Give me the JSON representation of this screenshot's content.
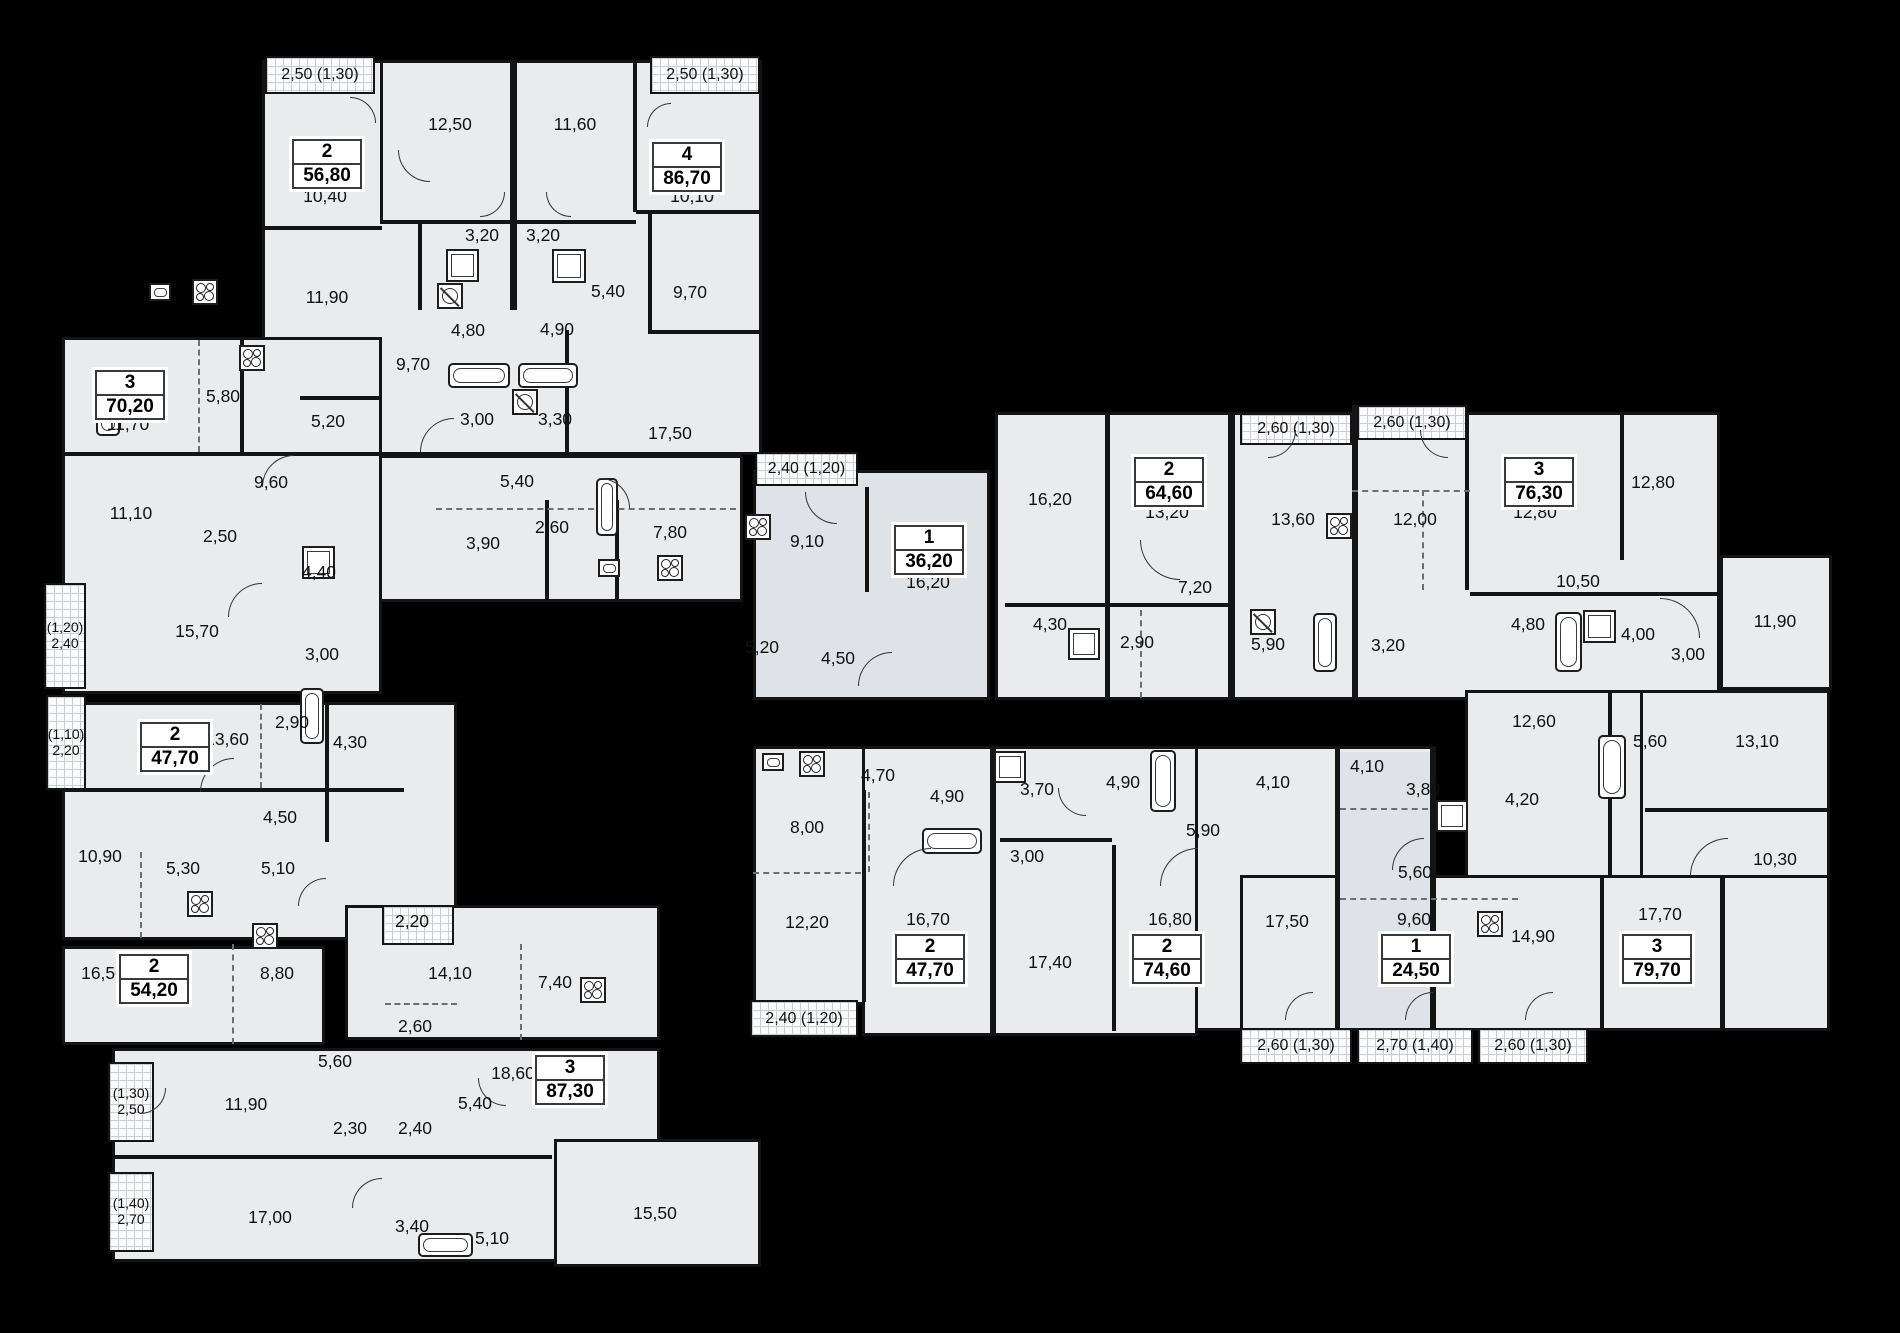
{
  "colors": {
    "background": "#000000",
    "floor": "#e9ebed",
    "floor_dark": "#dfe2e6",
    "wall": "#141414",
    "label": "#111111",
    "balcony_fill": "#fbfbfb",
    "balcony_grid": "#c9ced3"
  },
  "apartments": [
    {
      "type": "2",
      "area": "56,80",
      "x": 325,
      "y": 162
    },
    {
      "type": "4",
      "area": "86,70",
      "x": 685,
      "y": 165
    },
    {
      "type": "3",
      "area": "70,20",
      "x": 128,
      "y": 393
    },
    {
      "type": "1",
      "area": "36,20",
      "x": 927,
      "y": 548
    },
    {
      "type": "2",
      "area": "64,60",
      "x": 1167,
      "y": 480
    },
    {
      "type": "3",
      "area": "76,30",
      "x": 1537,
      "y": 480
    },
    {
      "type": "2",
      "area": "47,70",
      "x": 173,
      "y": 745
    },
    {
      "type": "2",
      "area": "54,20",
      "x": 152,
      "y": 977
    },
    {
      "type": "3",
      "area": "87,30",
      "x": 568,
      "y": 1078
    },
    {
      "type": "2",
      "area": "47,70",
      "x": 928,
      "y": 957
    },
    {
      "type": "2",
      "area": "74,60",
      "x": 1165,
      "y": 957
    },
    {
      "type": "1",
      "area": "24,50",
      "x": 1414,
      "y": 957
    },
    {
      "type": "3",
      "area": "79,70",
      "x": 1655,
      "y": 957
    }
  ],
  "rooms": [
    [
      "12,50",
      450,
      125
    ],
    [
      "11,60",
      575,
      125
    ],
    [
      "10,40",
      325,
      197
    ],
    [
      "10,10",
      692,
      197
    ],
    [
      "11,90",
      327,
      298
    ],
    [
      "3,20",
      482,
      236
    ],
    [
      "3,20",
      543,
      236
    ],
    [
      "5,40",
      608,
      292
    ],
    [
      "9,70",
      690,
      293
    ],
    [
      "4,80",
      468,
      331
    ],
    [
      "4,90",
      557,
      330
    ],
    [
      "9,70",
      413,
      365
    ],
    [
      "5,20",
      328,
      422
    ],
    [
      "3,00",
      477,
      420
    ],
    [
      "3,30",
      555,
      420
    ],
    [
      "17,50",
      670,
      434
    ],
    [
      "5,40",
      517,
      482
    ],
    [
      "3,90",
      483,
      544
    ],
    [
      "2,60",
      552,
      528
    ],
    [
      "7,80",
      670,
      533
    ],
    [
      "5,80",
      223,
      397
    ],
    [
      "11,70",
      128,
      425
    ],
    [
      "9,60",
      271,
      483
    ],
    [
      "11,10",
      131,
      514
    ],
    [
      "2,50",
      220,
      537
    ],
    [
      "4,40",
      319,
      573
    ],
    [
      "15,70",
      197,
      632
    ],
    [
      "3,00",
      322,
      655
    ],
    [
      "9,10",
      807,
      542
    ],
    [
      "16,20",
      928,
      583
    ],
    [
      "5,20",
      762,
      648
    ],
    [
      "4,50",
      838,
      659
    ],
    [
      "16,20",
      1050,
      500
    ],
    [
      "13,20",
      1167,
      513
    ],
    [
      "13,60",
      1293,
      520
    ],
    [
      "7,20",
      1195,
      588
    ],
    [
      "4,30",
      1050,
      625
    ],
    [
      "2,90",
      1137,
      643
    ],
    [
      "5,90",
      1268,
      645
    ],
    [
      "3,20",
      1388,
      646
    ],
    [
      "12,00",
      1415,
      520
    ],
    [
      "12,80",
      1535,
      513
    ],
    [
      "12,80",
      1653,
      483
    ],
    [
      "10,50",
      1578,
      582
    ],
    [
      "4,80",
      1528,
      625
    ],
    [
      "4,00",
      1638,
      635
    ],
    [
      "3,00",
      1688,
      655
    ],
    [
      "11,90",
      1775,
      622
    ],
    [
      "12,60",
      1534,
      722
    ],
    [
      "5,60",
      1650,
      742
    ],
    [
      "13,10",
      1757,
      742
    ],
    [
      "4,20",
      1522,
      800
    ],
    [
      "10,30",
      1775,
      860
    ],
    [
      "4,10",
      1367,
      767
    ],
    [
      "3,80",
      1423,
      790
    ],
    [
      "5,60",
      1415,
      873
    ],
    [
      "9,60",
      1414,
      920
    ],
    [
      "17,50",
      1287,
      922
    ],
    [
      "14,90",
      1533,
      937
    ],
    [
      "17,70",
      1660,
      915
    ],
    [
      "4,70",
      878,
      776
    ],
    [
      "4,90",
      947,
      797
    ],
    [
      "8,00",
      807,
      828
    ],
    [
      "12,20",
      807,
      923
    ],
    [
      "16,70",
      928,
      920
    ],
    [
      "3,70",
      1037,
      790
    ],
    [
      "4,90",
      1123,
      783
    ],
    [
      "3,00",
      1027,
      857
    ],
    [
      "5,90",
      1203,
      831
    ],
    [
      "4,10",
      1273,
      783
    ],
    [
      "17,40",
      1050,
      963
    ],
    [
      "16,80",
      1170,
      920
    ],
    [
      "13,60",
      227,
      740
    ],
    [
      "2,90",
      292,
      723
    ],
    [
      "4,30",
      350,
      743
    ],
    [
      "4,50",
      280,
      818
    ],
    [
      "10,90",
      100,
      857
    ],
    [
      "5,30",
      183,
      869
    ],
    [
      "5,10",
      278,
      869
    ],
    [
      "16,50",
      103,
      974
    ],
    [
      "8,80",
      277,
      974
    ],
    [
      "2,20",
      412,
      922
    ],
    [
      "14,10",
      450,
      974
    ],
    [
      "7,40",
      555,
      983
    ],
    [
      "2,60",
      415,
      1027
    ],
    [
      "5,60",
      335,
      1062
    ],
    [
      "18,60",
      513,
      1074
    ],
    [
      "11,90",
      246,
      1105
    ],
    [
      "5,40",
      475,
      1104
    ],
    [
      "2,30",
      350,
      1129
    ],
    [
      "2,40",
      415,
      1129
    ],
    [
      "17,00",
      270,
      1218
    ],
    [
      "3,40",
      412,
      1227
    ],
    [
      "5,10",
      492,
      1239
    ],
    [
      "15,50",
      655,
      1214
    ]
  ],
  "balconies": [
    {
      "label": "2,50 (1,30)",
      "r": [
        265,
        56,
        110,
        38
      ]
    },
    {
      "label": "2,50 (1,30)",
      "r": [
        650,
        56,
        110,
        38
      ]
    },
    {
      "label": "(1,20)\n2,40",
      "r": [
        44,
        583,
        42,
        106
      ]
    },
    {
      "label": "(1,10)\n2,20",
      "r": [
        46,
        695,
        40,
        95
      ]
    },
    {
      "label": "2,40 (1,20)",
      "r": [
        755,
        452,
        103,
        34
      ]
    },
    {
      "label": "2,60 (1,30)",
      "r": [
        1240,
        413,
        112,
        32
      ]
    },
    {
      "label": "2,60 (1,30)",
      "r": [
        1357,
        405,
        110,
        35
      ]
    },
    {
      "label": "2,40 (1,20)",
      "r": [
        750,
        1000,
        108,
        37
      ]
    },
    {
      "label": "2,60 (1,30)",
      "r": [
        1240,
        1028,
        112,
        36
      ]
    },
    {
      "label": "2,70 (1,40)",
      "r": [
        1357,
        1028,
        116,
        36
      ]
    },
    {
      "label": "2,60 (1,30)",
      "r": [
        1478,
        1028,
        110,
        36
      ]
    },
    {
      "label": "(1,30)\n2,50",
      "r": [
        108,
        1062,
        46,
        80
      ]
    },
    {
      "label": "(1,40)\n2,70",
      "r": [
        108,
        1172,
        46,
        80
      ]
    },
    {
      "label": "",
      "r": [
        382,
        905,
        72,
        40
      ]
    }
  ],
  "blocks": [
    [
      262,
      60,
      500,
      395
    ],
    [
      375,
      455,
      368,
      147
    ],
    [
      62,
      337,
      320,
      357
    ],
    [
      753,
      470,
      237,
      230,
      "b"
    ],
    [
      995,
      412,
      725,
      288
    ],
    [
      1720,
      555,
      112,
      135
    ],
    [
      1465,
      690,
      365,
      190
    ],
    [
      1640,
      690,
      190,
      341
    ],
    [
      995,
      746,
      440,
      285
    ],
    [
      1240,
      875,
      590,
      156
    ],
    [
      753,
      746,
      445,
      259
    ],
    [
      862,
      746,
      336,
      290
    ],
    [
      62,
      702,
      395,
      238
    ],
    [
      62,
      946,
      263,
      99
    ],
    [
      345,
      905,
      315,
      135
    ],
    [
      112,
      1048,
      548,
      214
    ],
    [
      554,
      1139,
      207,
      128
    ]
  ],
  "shades": [
    [
      1338,
      752,
      94,
      276
    ]
  ],
  "walls": [
    [
      510,
      62,
      7,
      248
    ],
    [
      633,
      62,
      4,
      150
    ],
    [
      380,
      62,
      3,
      160
    ],
    [
      262,
      226,
      120,
      4
    ],
    [
      380,
      220,
      256,
      4
    ],
    [
      418,
      224,
      4,
      86
    ],
    [
      636,
      210,
      126,
      4
    ],
    [
      648,
      214,
      4,
      118
    ],
    [
      62,
      452,
      318,
      4
    ],
    [
      240,
      337,
      4,
      115
    ],
    [
      300,
      396,
      80,
      4
    ],
    [
      380,
      452,
      140,
      4
    ],
    [
      565,
      330,
      4,
      126
    ],
    [
      648,
      330,
      114,
      4
    ],
    [
      545,
      500,
      4,
      100
    ],
    [
      615,
      500,
      4,
      100
    ],
    [
      865,
      487,
      4,
      105
    ],
    [
      1105,
      412,
      5,
      285
    ],
    [
      1228,
      412,
      7,
      288
    ],
    [
      1352,
      405,
      6,
      295
    ],
    [
      1465,
      412,
      4,
      178
    ],
    [
      1620,
      412,
      4,
      148
    ],
    [
      1470,
      592,
      252,
      4
    ],
    [
      1005,
      603,
      225,
      4
    ],
    [
      1608,
      690,
      4,
      186
    ],
    [
      1645,
      808,
      185,
      4
    ],
    [
      1430,
      746,
      6,
      284
    ],
    [
      1335,
      746,
      5,
      284
    ],
    [
      1600,
      875,
      4,
      156
    ],
    [
      1720,
      875,
      5,
      156
    ],
    [
      862,
      790,
      4,
      212
    ],
    [
      990,
      746,
      6,
      290
    ],
    [
      1112,
      845,
      4,
      186
    ],
    [
      1000,
      838,
      112,
      4
    ],
    [
      62,
      788,
      342,
      4
    ],
    [
      325,
      702,
      4,
      140
    ],
    [
      112,
      1155,
      440,
      4
    ]
  ],
  "dashed": [
    [
      198,
      340,
      2,
      112,
      "v"
    ],
    [
      436,
      508,
      300,
      2,
      "h"
    ],
    [
      1140,
      610,
      2,
      88,
      "v"
    ],
    [
      1352,
      490,
      118,
      2,
      "h"
    ],
    [
      1422,
      490,
      2,
      100,
      "v"
    ],
    [
      1340,
      808,
      88,
      2,
      "h"
    ],
    [
      1340,
      898,
      178,
      2,
      "h"
    ],
    [
      753,
      872,
      108,
      2,
      "h"
    ],
    [
      868,
      792,
      2,
      80,
      "v"
    ],
    [
      232,
      944,
      2,
      100,
      "v"
    ],
    [
      260,
      704,
      2,
      84,
      "v"
    ],
    [
      385,
      1003,
      72,
      2,
      "h"
    ],
    [
      140,
      852,
      2,
      86,
      "v"
    ],
    [
      520,
      944,
      2,
      96,
      "v"
    ]
  ],
  "fixtures": {
    "stoves": [
      [
        239,
        345
      ],
      [
        192,
        279
      ],
      [
        657,
        555
      ],
      [
        745,
        514
      ],
      [
        1326,
        513
      ],
      [
        1477,
        911
      ],
      [
        799,
        751
      ],
      [
        187,
        891
      ],
      [
        252,
        923
      ],
      [
        580,
        977
      ]
    ],
    "tubs": [
      [
        448,
        363,
        62,
        25
      ],
      [
        518,
        363,
        60,
        25
      ],
      [
        96,
        378,
        24,
        58
      ],
      [
        596,
        478,
        22,
        58
      ],
      [
        1313,
        613,
        24,
        59
      ],
      [
        1555,
        612,
        27,
        60
      ],
      [
        922,
        828,
        60,
        26
      ],
      [
        1150,
        750,
        26,
        62
      ],
      [
        1598,
        735,
        28,
        64
      ],
      [
        418,
        1233,
        55,
        24
      ],
      [
        300,
        688,
        24,
        56
      ]
    ],
    "showers": [
      [
        446,
        249,
        33,
        33
      ],
      [
        552,
        249,
        34,
        34
      ],
      [
        302,
        546,
        33,
        33
      ],
      [
        1068,
        628,
        32,
        32
      ],
      [
        994,
        751,
        32,
        32
      ],
      [
        1583,
        610,
        33,
        33
      ],
      [
        1436,
        800,
        32,
        32
      ]
    ],
    "sinks": [
      [
        598,
        559,
        22,
        18
      ],
      [
        762,
        753,
        22,
        18
      ],
      [
        149,
        283,
        22,
        18
      ]
    ],
    "vents": [
      [
        437,
        283,
        26,
        26
      ],
      [
        512,
        389,
        26,
        26
      ],
      [
        1250,
        609,
        26,
        26
      ]
    ]
  },
  "arcs": [
    [
      350,
      97,
      26,
      "tr"
    ],
    [
      398,
      150,
      32,
      "bl"
    ],
    [
      480,
      192,
      25,
      "br"
    ],
    [
      546,
      192,
      25,
      "bl"
    ],
    [
      647,
      103,
      24,
      "tl"
    ],
    [
      420,
      418,
      34,
      "tl"
    ],
    [
      600,
      478,
      30,
      "tr"
    ],
    [
      262,
      455,
      32,
      "tl"
    ],
    [
      228,
      583,
      34,
      "tl"
    ],
    [
      805,
      492,
      32,
      "bl"
    ],
    [
      858,
      652,
      34,
      "tl"
    ],
    [
      1140,
      540,
      40,
      "bl"
    ],
    [
      1268,
      430,
      28,
      "br"
    ],
    [
      1420,
      430,
      28,
      "bl"
    ],
    [
      1660,
      598,
      40,
      "tr"
    ],
    [
      893,
      848,
      38,
      "tl"
    ],
    [
      1058,
      788,
      28,
      "bl"
    ],
    [
      1160,
      848,
      38,
      "tl"
    ],
    [
      1392,
      838,
      32,
      "tl"
    ],
    [
      1690,
      838,
      38,
      "tl"
    ],
    [
      1285,
      992,
      28,
      "tl"
    ],
    [
      1405,
      992,
      28,
      "tl"
    ],
    [
      1525,
      992,
      28,
      "tl"
    ],
    [
      200,
      758,
      34,
      "tl"
    ],
    [
      298,
      878,
      28,
      "tl"
    ],
    [
      140,
      1088,
      26,
      "br"
    ],
    [
      352,
      1178,
      30,
      "tl"
    ],
    [
      478,
      1078,
      28,
      "bl"
    ]
  ]
}
